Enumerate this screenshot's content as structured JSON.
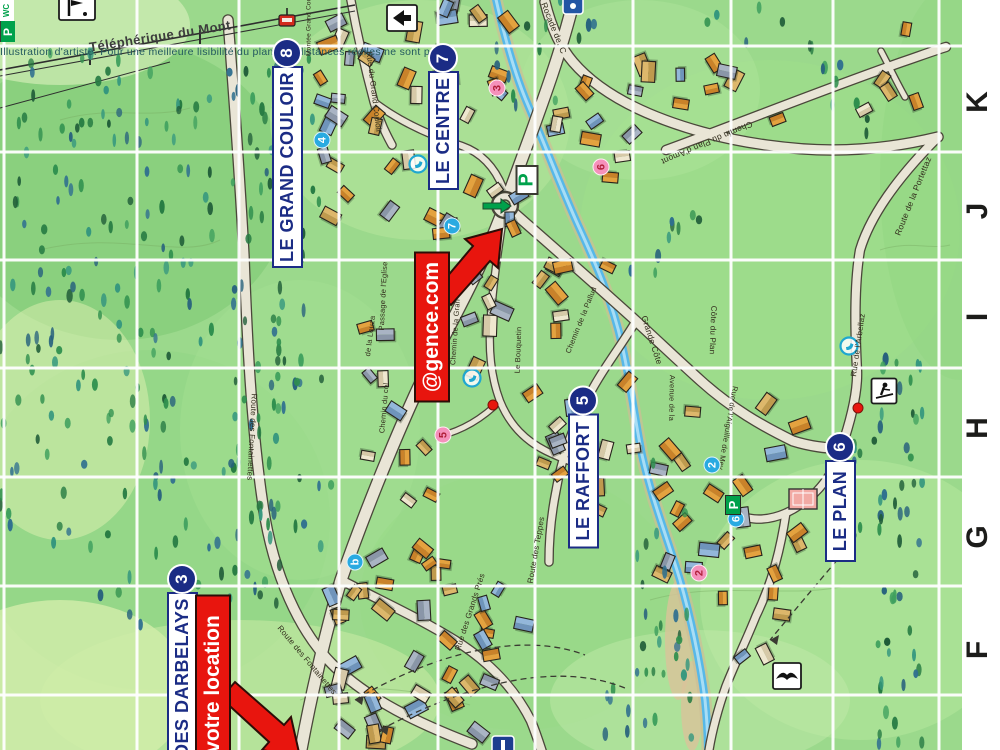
{
  "map": {
    "disclaimer": "Illustration d'artiste. Pour une meilleure lisibilité du plan, les distances réelles ne sont p",
    "colors": {
      "navy": "#1b2c85",
      "red": "#e8150e",
      "cyan": "#29aae1",
      "pink": "#f591bb",
      "green": "#00a14b"
    },
    "grid_letters": [
      {
        "label": "K",
        "y": 102
      },
      {
        "label": "J",
        "y": 211
      },
      {
        "label": "I",
        "y": 317
      },
      {
        "label": "H",
        "y": 428
      },
      {
        "label": "G",
        "y": 537
      },
      {
        "label": "F",
        "y": 650
      }
    ],
    "region_labels": [
      {
        "id": "grand-couloir",
        "label": "LE GRAND COULOIR",
        "badge": "8",
        "x": 287,
        "cy": 154,
        "len": 228
      },
      {
        "id": "centre",
        "label": "LE CENTRE",
        "badge": "7",
        "x": 443,
        "cy": 117,
        "len": 146
      },
      {
        "id": "raffort",
        "label": "LE RAFFORT",
        "badge": "5",
        "x": 583,
        "cy": 467,
        "len": 163
      },
      {
        "id": "plan",
        "label": "LE PLAN",
        "badge": "6",
        "x": 840,
        "cy": 497,
        "len": 130
      },
      {
        "id": "darbelays",
        "label": "DES DARBELAYS",
        "badge": "3",
        "x": 182,
        "cy": 668,
        "len": 190
      }
    ],
    "banners": [
      {
        "id": "agence",
        "label": "@gence.com",
        "x": 432,
        "cy": 327,
        "len": 147
      },
      {
        "id": "votre-location",
        "label": "votre location",
        "x": 213,
        "cy": 684,
        "len": 175
      }
    ],
    "markers_cyan": [
      {
        "label": "4",
        "x": 322,
        "y": 140
      },
      {
        "label": "7",
        "x": 452,
        "y": 226
      },
      {
        "label": "2",
        "x": 712,
        "y": 465
      },
      {
        "label": "6",
        "x": 736,
        "y": 519
      },
      {
        "label": "b",
        "x": 355,
        "y": 562
      }
    ],
    "markers_pink": [
      {
        "label": "3",
        "x": 497,
        "y": 88
      },
      {
        "label": "6",
        "x": 601,
        "y": 167
      },
      {
        "label": "5",
        "x": 443,
        "y": 435
      },
      {
        "label": "2",
        "x": 699,
        "y": 573
      }
    ],
    "poi_dots": [
      {
        "x": 493,
        "y": 405
      },
      {
        "x": 858,
        "y": 408
      }
    ],
    "streets": [
      {
        "label": "Téléphérique du Mont",
        "x": 160,
        "y": 36,
        "rot": -9,
        "size": 13,
        "big": true
      },
      {
        "label": "Montée Grand Couloir",
        "x": 309,
        "y": 22,
        "rot": -90,
        "size": 6.5
      },
      {
        "label": "Rue du Grand Couloir",
        "x": 374,
        "y": 92,
        "rot": 83,
        "size": 8
      },
      {
        "label": "Rocade de. C",
        "x": 554,
        "y": 28,
        "rot": 68,
        "size": 8.5
      },
      {
        "label": "Chemin du Plan d'Amont",
        "x": 707,
        "y": 143,
        "rot": 157,
        "size": 8.5
      },
      {
        "label": "Route de la Portettaz",
        "x": 913,
        "y": 196,
        "rot": -68,
        "size": 8.5
      },
      {
        "label": "Route des Fontainettes",
        "x": 252,
        "y": 437,
        "rot": 93,
        "size": 8
      },
      {
        "label": "Route des Fontainettes",
        "x": 307,
        "y": 660,
        "rot": 50,
        "size": 8
      },
      {
        "label": "Passage de l'Eglise",
        "x": 383,
        "y": 296,
        "rot": -87,
        "size": 7.5
      },
      {
        "label": "de la Louza",
        "x": 370,
        "y": 336,
        "rot": -83,
        "size": 7.5
      },
      {
        "label": "Chemin du col",
        "x": 384,
        "y": 408,
        "rot": -85,
        "size": 7.5
      },
      {
        "label": "Chemin de la Gran",
        "x": 455,
        "y": 332,
        "rot": -86,
        "size": 7.5
      },
      {
        "label": "Le Bouquetin",
        "x": 518,
        "y": 350,
        "rot": -88,
        "size": 7.5
      },
      {
        "label": "Chemin de la Pallud",
        "x": 581,
        "y": 320,
        "rot": -68,
        "size": 7.5
      },
      {
        "label": "Grande Côte",
        "x": 652,
        "y": 340,
        "rot": 72,
        "size": 8.5
      },
      {
        "label": "Côte du Plan",
        "x": 713,
        "y": 330,
        "rot": 92,
        "size": 8
      },
      {
        "label": "Avenue de la",
        "x": 672,
        "y": 398,
        "rot": 91,
        "size": 7.5
      },
      {
        "label": "Rue de l'Aiguille de Mey",
        "x": 728,
        "y": 428,
        "rot": 100,
        "size": 7.5
      },
      {
        "label": "Rue de l'Arbellaz",
        "x": 858,
        "y": 345,
        "rot": -82,
        "size": 8
      },
      {
        "label": "Rue des Grands Prés",
        "x": 470,
        "y": 612,
        "rot": -72,
        "size": 8
      },
      {
        "label": "Route des Teppes",
        "x": 536,
        "y": 550,
        "rot": -80,
        "size": 8
      }
    ],
    "amenities": {
      "parking_label": "P",
      "wc_label": "WC",
      "parking": [
        {
          "x": 527,
          "y": 180,
          "variant": "outline"
        },
        {
          "x": 733,
          "y": 505,
          "variant": "solid"
        }
      ],
      "wc_sign": {
        "x": 492,
        "y": 363
      },
      "phones": [
        {
          "x": 418,
          "y": 164
        },
        {
          "x": 472,
          "y": 378
        },
        {
          "x": 849,
          "y": 346
        }
      ]
    },
    "signs": [
      {
        "type": "info-sign",
        "x": 77,
        "y": 8
      },
      {
        "type": "direction-arrow-sign",
        "x": 402,
        "y": 18
      },
      {
        "type": "blue-sign-top",
        "x": 573,
        "y": 4
      },
      {
        "type": "skier-crossing-sign",
        "x": 884,
        "y": 391
      },
      {
        "type": "bird-sign",
        "x": 787,
        "y": 676
      },
      {
        "type": "blue-sign-bottom",
        "x": 503,
        "y": 742
      },
      {
        "type": "tennis-court",
        "x": 803,
        "y": 499
      },
      {
        "type": "green-direction-arrow",
        "x": 497,
        "y": 206
      },
      {
        "type": "cablecar-gondola",
        "x": 287,
        "y": 17
      }
    ]
  }
}
